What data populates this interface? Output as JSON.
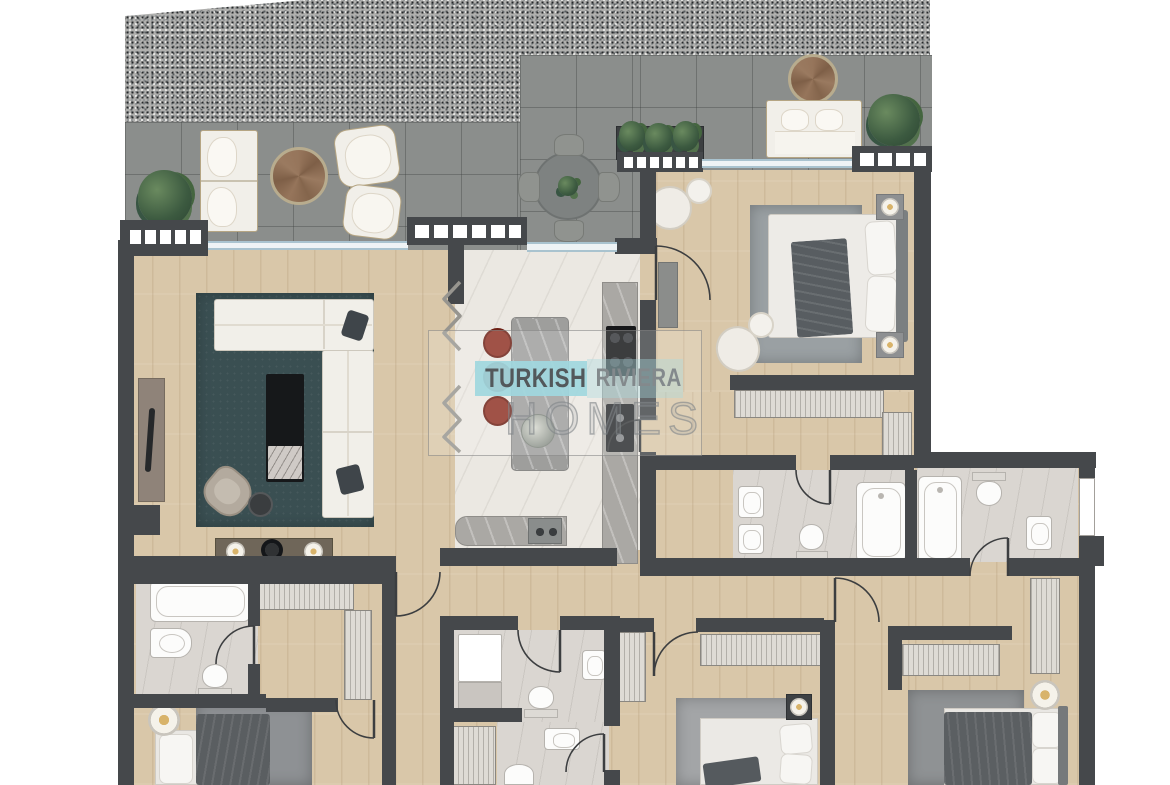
{
  "watermark": {
    "brand_word_1": "TURKISH",
    "brand_word_2": "RIVIERA",
    "brand_word_3": "HOMES"
  },
  "palette": {
    "wall": "#45484b",
    "wood": "#d9c7a9",
    "tile": "#8b8e8c",
    "kitchen-marble": "#ebe8e2",
    "bath-floor": "#dad6d1",
    "rug-teal": "#3a4f52",
    "furniture-white": "#f1efe9",
    "furniture-dark": "#53585c",
    "table-wood": "#96755b",
    "stool-red": "#8e3124",
    "glass-blue": "#a9c3cf",
    "watermark-teal": "#a0d7de",
    "plant-green": "#4a6647",
    "island-gray": "#9e9e9c"
  }
}
